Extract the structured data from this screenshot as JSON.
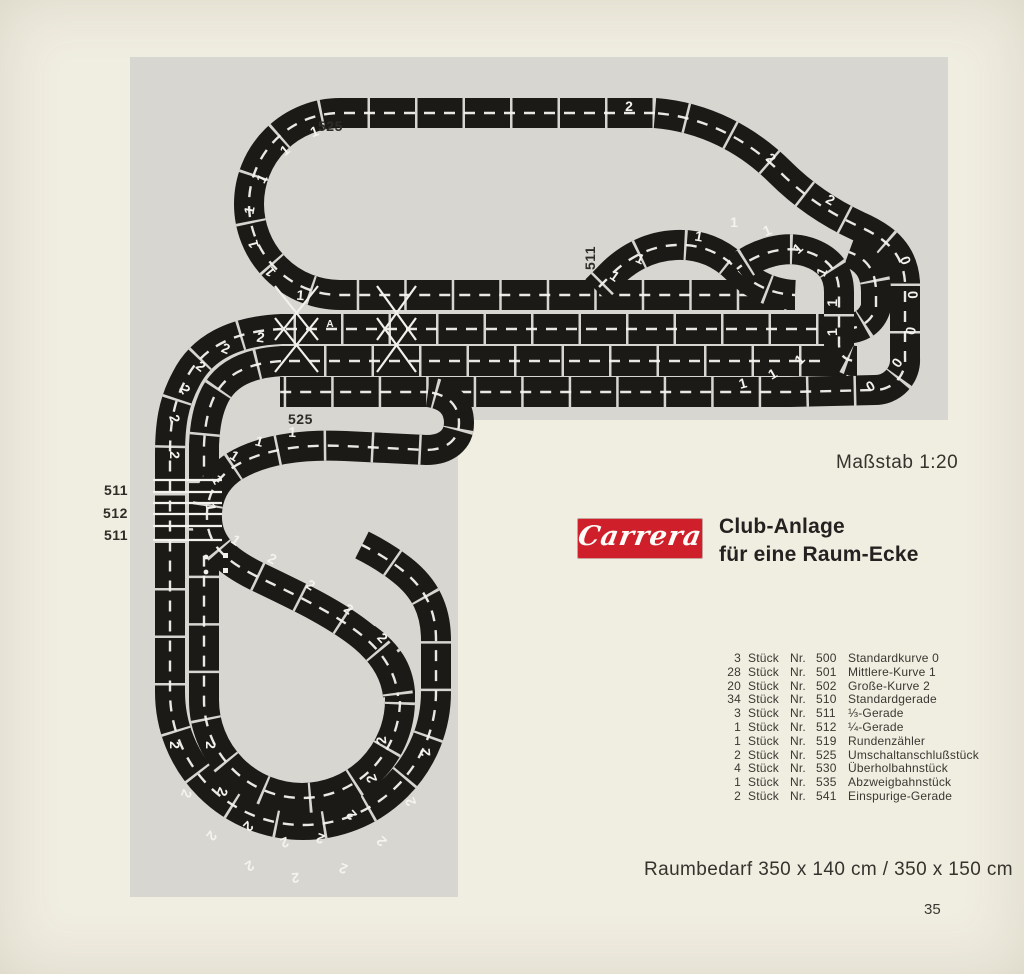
{
  "colors": {
    "page_bg": "#f0ede1",
    "photo_bg": "#d8d6d0",
    "track": "#1b1a17",
    "brand_red": "#cf1f2b",
    "ink": "#35332d"
  },
  "scale_note": "Maßstab 1:20",
  "brand": {
    "logo_text": "Carrera",
    "title_line1": "Club-Anlage",
    "title_line2": "für eine Raum-Ecke"
  },
  "parts_list": {
    "unit_label": "Stück",
    "nr_label": "Nr.",
    "items": [
      {
        "qty": "3",
        "num": "500",
        "name": "Standardkurve 0"
      },
      {
        "qty": "28",
        "num": "501",
        "name": "Mittlere-Kurve 1"
      },
      {
        "qty": "20",
        "num": "502",
        "name": "Große-Kurve 2"
      },
      {
        "qty": "34",
        "num": "510",
        "name": "Standardgerade"
      },
      {
        "qty": "3",
        "num": "511",
        "name": "⅓-Gerade"
      },
      {
        "qty": "1",
        "num": "512",
        "name": "¼-Gerade"
      },
      {
        "qty": "1",
        "num": "519",
        "name": "Rundenzähler"
      },
      {
        "qty": "2",
        "num": "525",
        "name": "Umschaltanschlußstück"
      },
      {
        "qty": "4",
        "num": "530",
        "name": "Überholbahnstück"
      },
      {
        "qty": "1",
        "num": "535",
        "name": "Abzweigbahnstück"
      },
      {
        "qty": "2",
        "num": "541",
        "name": "Einspurige-Gerade"
      }
    ]
  },
  "space_note": "Raumbedarf 350 x 140 cm / 350 x 150 cm",
  "page_number": "35",
  "photo_labels": [
    {
      "text": "525",
      "x": 318,
      "y": 118,
      "rot": 0
    },
    {
      "text": "511",
      "x": 578,
      "y": 250,
      "rot": -90
    },
    {
      "text": "525",
      "x": 288,
      "y": 411,
      "rot": 0
    },
    {
      "text": "511",
      "x": 104,
      "y": 482,
      "rot": 0
    },
    {
      "text": "512",
      "x": 103,
      "y": 505,
      "rot": 0
    },
    {
      "text": "511",
      "x": 104,
      "y": 527,
      "rot": 0
    }
  ],
  "track_markings": [
    [
      316,
      136,
      -20,
      "1"
    ],
    [
      288,
      154,
      -40,
      "1"
    ],
    [
      266,
      181,
      -60,
      "1"
    ],
    [
      254,
      211,
      -80,
      "1"
    ],
    [
      258,
      243,
      -105,
      "1"
    ],
    [
      274,
      269,
      -128,
      "1"
    ],
    [
      300,
      300,
      5,
      "1"
    ],
    [
      629,
      111,
      0,
      "2"
    ],
    [
      768,
      162,
      40,
      "2"
    ],
    [
      828,
      204,
      30,
      "2"
    ],
    [
      698,
      241,
      10,
      "1"
    ],
    [
      734,
      227,
      0,
      "1"
    ],
    [
      769,
      235,
      -22,
      "1"
    ],
    [
      801,
      252,
      -42,
      "1"
    ],
    [
      826,
      274,
      -65,
      "1"
    ],
    [
      837,
      303,
      -88,
      "1"
    ],
    [
      837,
      332,
      -92,
      "1"
    ],
    [
      744,
      388,
      -15,
      "1"
    ],
    [
      775,
      378,
      -30,
      "1"
    ],
    [
      803,
      363,
      -45,
      "1"
    ],
    [
      638,
      263,
      25,
      "1"
    ],
    [
      612,
      280,
      35,
      "1"
    ],
    [
      260,
      342,
      8,
      "2"
    ],
    [
      224,
      353,
      22,
      "2"
    ],
    [
      198,
      370,
      38,
      "2"
    ],
    [
      181,
      392,
      58,
      "2"
    ],
    [
      170,
      420,
      75,
      "2"
    ],
    [
      170,
      455,
      90,
      "2"
    ],
    [
      292,
      437,
      3,
      "1"
    ],
    [
      258,
      446,
      15,
      "1"
    ],
    [
      232,
      460,
      32,
      "1"
    ],
    [
      213,
      482,
      60,
      "1"
    ],
    [
      206,
      508,
      82,
      "1"
    ],
    [
      233,
      544,
      35,
      "1"
    ],
    [
      270,
      563,
      28,
      "2"
    ],
    [
      308,
      589,
      33,
      "2"
    ],
    [
      346,
      613,
      35,
      "2"
    ],
    [
      379,
      641,
      48,
      "2"
    ],
    [
      901,
      262,
      70,
      "0"
    ],
    [
      908,
      295,
      88,
      "0"
    ],
    [
      906,
      330,
      100,
      "0"
    ],
    [
      893,
      360,
      125,
      "0"
    ],
    [
      868,
      382,
      150,
      "0"
    ],
    [
      170,
      745,
      90,
      "2"
    ],
    [
      182,
      792,
      110,
      "2"
    ],
    [
      208,
      833,
      128,
      "2"
    ],
    [
      247,
      862,
      148,
      "2"
    ],
    [
      295,
      873,
      175,
      "2"
    ],
    [
      345,
      864,
      -160,
      "2"
    ],
    [
      385,
      838,
      -135,
      "2"
    ],
    [
      415,
      800,
      -112,
      "2"
    ],
    [
      430,
      752,
      -95,
      "2"
    ],
    [
      206,
      745,
      90,
      "2"
    ],
    [
      218,
      790,
      112,
      "2"
    ],
    [
      245,
      823,
      135,
      "2"
    ],
    [
      283,
      838,
      160,
      "2"
    ],
    [
      322,
      834,
      -160,
      "2"
    ],
    [
      355,
      812,
      -132,
      "2"
    ],
    [
      376,
      777,
      -110,
      "2"
    ],
    [
      386,
      740,
      -95,
      "2"
    ],
    [
      330,
      327,
      0,
      "A"
    ]
  ]
}
